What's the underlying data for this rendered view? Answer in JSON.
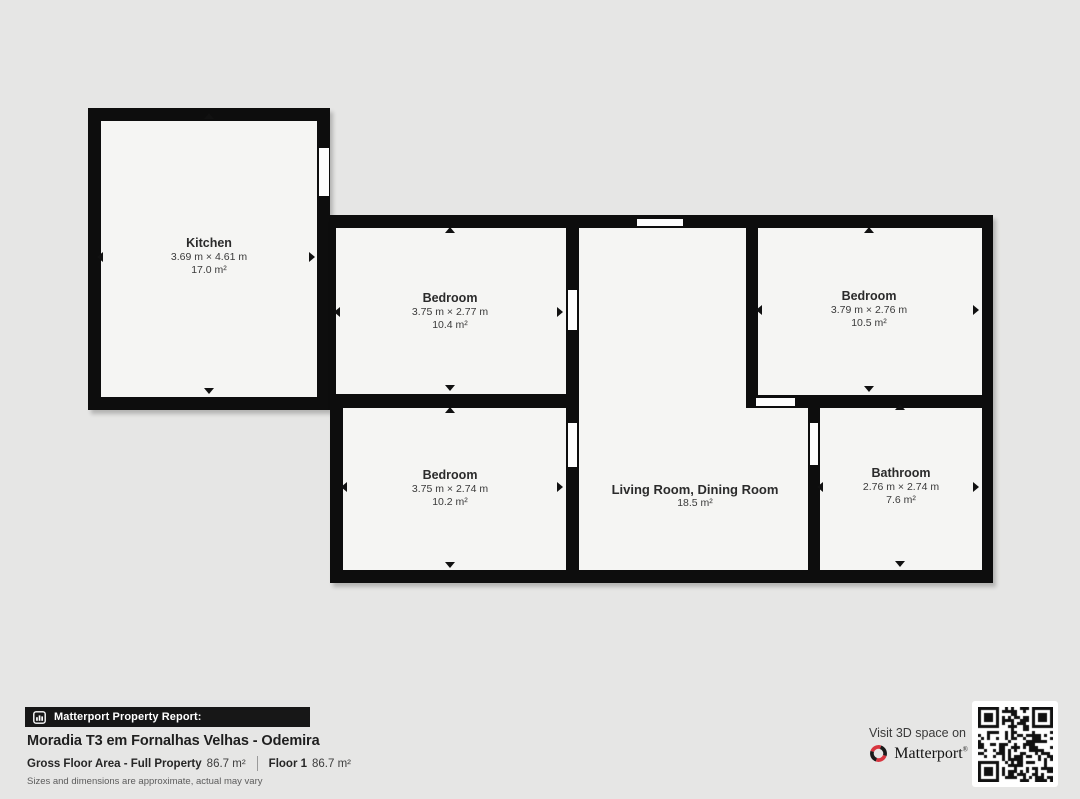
{
  "plan": {
    "rooms": {
      "kitchen": {
        "name": "Kitchen",
        "dimensions": "3.69 m × 4.61 m",
        "area": "17.0 m²"
      },
      "bedroom_top": {
        "name": "Bedroom",
        "dimensions": "3.75 m × 2.77 m",
        "area": "10.4 m²"
      },
      "bedroom_right": {
        "name": "Bedroom",
        "dimensions": "3.79 m × 2.76 m",
        "area": "10.5 m²"
      },
      "bedroom_bottom": {
        "name": "Bedroom",
        "dimensions": "3.75 m × 2.74 m",
        "area": "10.2 m²"
      },
      "living": {
        "name": "Living Room, Dining Room",
        "area": "18.5 m²"
      },
      "bathroom": {
        "name": "Bathroom",
        "dimensions": "2.76 m × 2.74 m",
        "area": "7.6 m²"
      }
    },
    "colors": {
      "wall": "#0d0d0d",
      "room_fill": "#f5f5f3",
      "background": "#e6e6e5"
    }
  },
  "report": {
    "banner_label": "Matterport Property Report:",
    "property_title": "Moradia T3 em Fornalhas Velhas - Odemira",
    "gross_floor_area_label": "Gross Floor Area - Full Property",
    "gross_floor_area_value": "86.7 m²",
    "floor_label": "Floor 1",
    "floor_value": "86.7 m²",
    "disclaimer": "Sizes and dimensions are approximate, actual may vary"
  },
  "promo": {
    "visit_text": "Visit 3D space on",
    "brand_name": "Matterport",
    "brand_red": "#d8353f"
  },
  "icons": {
    "banner_icon": "building-report-icon",
    "brand_icon": "matterport-pinwheel-icon",
    "qr": "qr-code"
  }
}
